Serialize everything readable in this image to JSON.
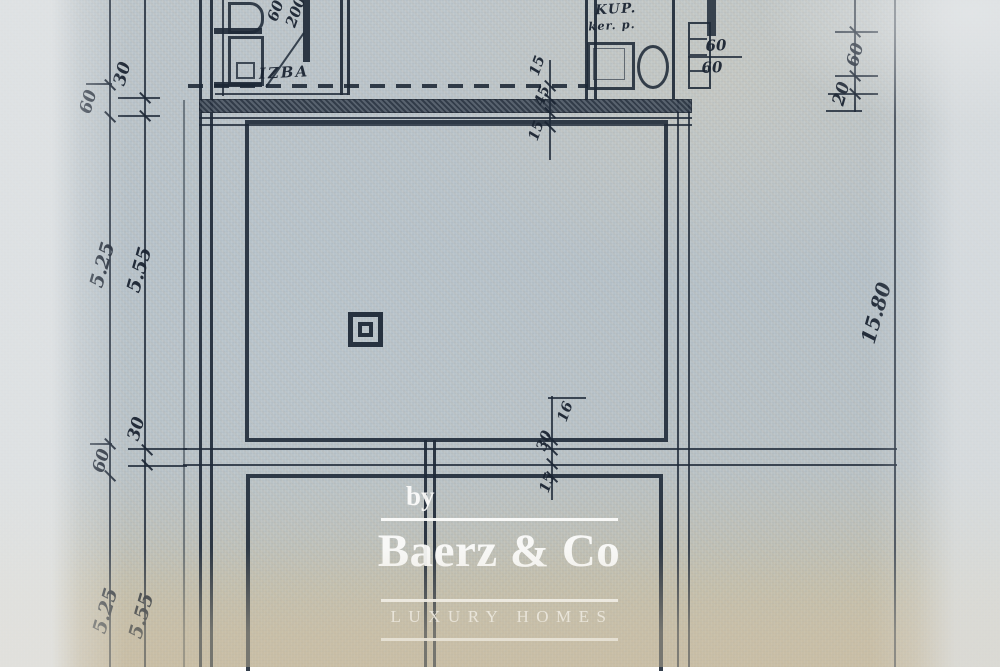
{
  "watermark": {
    "prefix": "by",
    "brand": "Baerz & Co",
    "tagline": "LUXURY HOMES",
    "text_color": "#fdfdfc"
  },
  "plan": {
    "room_labels": {
      "izba": "IZBA",
      "kup": "KUP.",
      "kup_sub": "ker. p."
    },
    "door_dims": {
      "width": "60",
      "height": "200"
    },
    "kup_side_dims": {
      "top": "60",
      "bottom": "60"
    },
    "dims_left_top": {
      "a": "30",
      "b": "60"
    },
    "dims_left_middle": {
      "a": "5.25",
      "b": "5.55"
    },
    "dims_left_lower": {
      "a": "30",
      "b": "60"
    },
    "dims_left_bottom": {
      "a": "5.25",
      "b": "5.55"
    },
    "dims_right_top": {
      "a": "60",
      "b": "20"
    },
    "dims_right_middle": {
      "a": "15.80"
    },
    "dims_wall_upper": [
      "15",
      "45",
      "15"
    ],
    "dims_wall_lower": [
      "16",
      "30",
      "15"
    ],
    "colors": {
      "ink": "#1f2a38",
      "paper": "#b7c1c7",
      "paper_warm": "#c6bca6"
    }
  }
}
